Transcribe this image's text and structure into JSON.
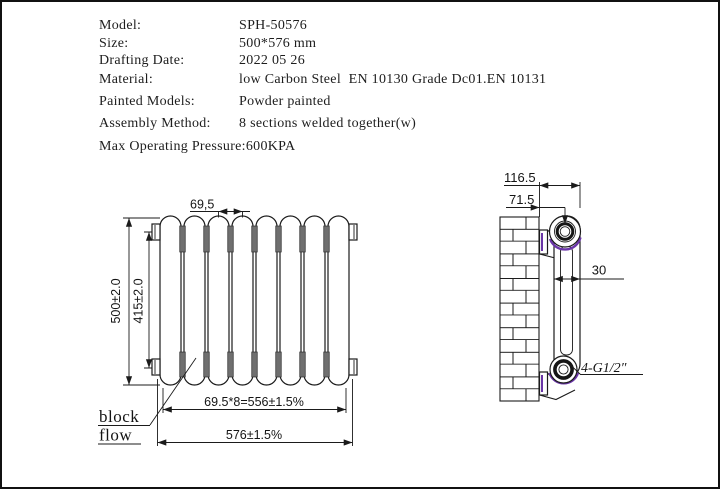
{
  "spec_table": {
    "rows": [
      {
        "label": "Model:",
        "value": "SPH-50576"
      },
      {
        "label": "Size:",
        "value": "500*576 mm"
      },
      {
        "label": "Drafting Date:",
        "value": "2022 05 26"
      },
      {
        "label": "Material:",
        "value": "low Carbon Steel  EN 10130 Grade Dc01.EN 10131"
      },
      {
        "label": "Painted Models:",
        "value": "Powder painted"
      },
      {
        "label": "Assembly Method:",
        "value": "8 sections welded together(w)"
      },
      {
        "label": "Max Operating Pressure:",
        "value": "600KPA"
      }
    ]
  },
  "front_view": {
    "section_count": 8,
    "dim_section_width": "69,5",
    "dim_height_overall": "500±2.0",
    "dim_height_inner": "415±2.0",
    "dim_width_sections": "69.5*8=556±1.5%",
    "dim_width_overall": "576±1.5%",
    "label_line1": "block",
    "label_line2": "flow"
  },
  "side_view": {
    "dim_depth_overall": "116.5",
    "dim_pipe_center": "71.5",
    "dim_column_width": "30",
    "thread_label": "4-G1/2″"
  },
  "colors": {
    "line": "#1b1b1b",
    "weld_gray": "#6f6f6f",
    "accent_purple": "#6a35a8"
  }
}
